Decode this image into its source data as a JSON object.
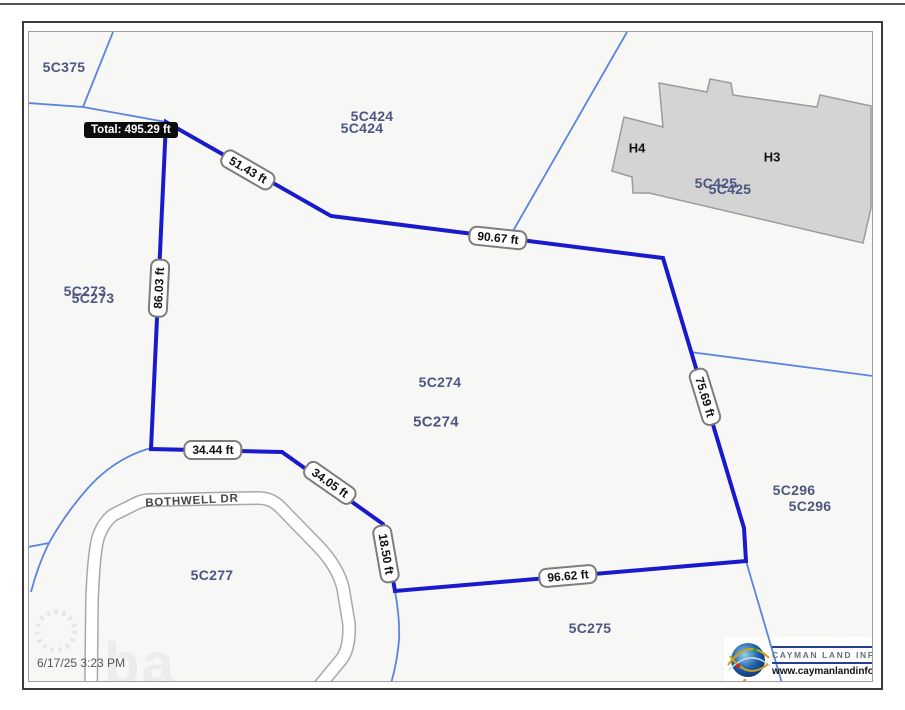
{
  "map": {
    "total_tooltip": "Total: 495.29 ft",
    "measurements": [
      "51.43 ft",
      "90.67 ft",
      "75.69 ft",
      "96.62 ft",
      "18.50 ft",
      "34.05 ft",
      "34.44 ft",
      "86.03 ft"
    ],
    "parcels": [
      "5C375",
      "5C424",
      "5C424",
      "5C425",
      "5C425",
      "5C273",
      "5C273",
      "5C274",
      "5C274",
      "5C296",
      "5C296",
      "5C277",
      "5C275"
    ],
    "buildings": [
      "H4",
      "H3"
    ],
    "street": "BOTHWELL DR",
    "timestamp": "6/17/25 3:23 PM",
    "watermark": "ba",
    "logo": {
      "name": "CAYMAN LAND INFO",
      "url": "www.caymanlandinfo.ky"
    },
    "colors": {
      "measure_line": "#1a1acd",
      "boundary_line": "#5b85dd",
      "parcel_label": "#4d5680",
      "building_fill": "#d4d4d4",
      "road_casing": "#a8a8a8",
      "total_bg": "#0c0c0c",
      "logo_navy": "#24408e"
    }
  }
}
